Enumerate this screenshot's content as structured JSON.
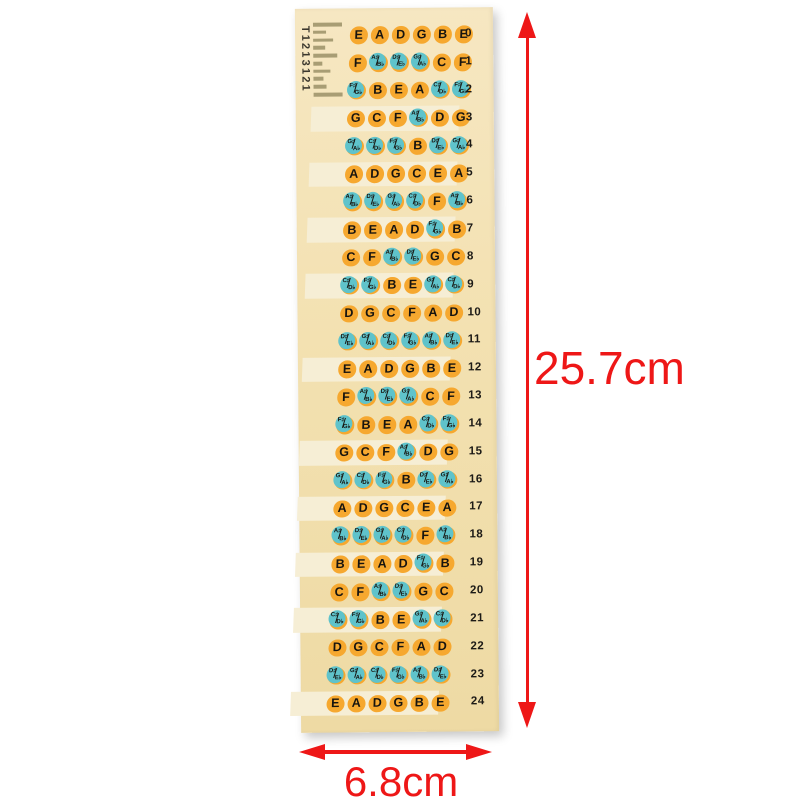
{
  "dimensions": {
    "height_label": "25.7cm",
    "width_label": "6.8cm"
  },
  "regmarks": {
    "text": "T1213121",
    "bar_widths": [
      29,
      13,
      20,
      12,
      24,
      9,
      17,
      10,
      13,
      29
    ]
  },
  "frets": [
    {
      "fret": "0",
      "marker": false,
      "notes": [
        "E",
        "A",
        "D",
        "G",
        "B",
        "E"
      ]
    },
    {
      "fret": "1",
      "marker": false,
      "notes": [
        "F",
        "A♯/B♭",
        "D♯/E♭",
        "G♯/A♭",
        "C",
        "F"
      ]
    },
    {
      "fret": "2",
      "marker": false,
      "notes": [
        "F♯/G♭",
        "B",
        "E",
        "A",
        "C♯/D♭",
        "F♯/G♭"
      ]
    },
    {
      "fret": "3",
      "marker": true,
      "notes": [
        "G",
        "C",
        "F",
        "A♯/B♭",
        "D",
        "G"
      ]
    },
    {
      "fret": "4",
      "marker": false,
      "notes": [
        "G♯/A♭",
        "C♯/D♭",
        "F♯/G♭",
        "B",
        "D♯/E♭",
        "G♯/A♭"
      ]
    },
    {
      "fret": "5",
      "marker": true,
      "notes": [
        "A",
        "D",
        "G",
        "C",
        "E",
        "A"
      ]
    },
    {
      "fret": "6",
      "marker": false,
      "notes": [
        "A♯/B♭",
        "D♯/E♭",
        "G♯/A♭",
        "C♯/D♭",
        "F",
        "A♯/B♭"
      ]
    },
    {
      "fret": "7",
      "marker": true,
      "notes": [
        "B",
        "E",
        "A",
        "D",
        "F♯/G♭",
        "B"
      ]
    },
    {
      "fret": "8",
      "marker": false,
      "notes": [
        "C",
        "F",
        "A♯/B♭",
        "D♯/E♭",
        "G",
        "C"
      ]
    },
    {
      "fret": "9",
      "marker": true,
      "notes": [
        "C♯/D♭",
        "F♯/G♭",
        "B",
        "E",
        "G♯/A♭",
        "C♯/D♭"
      ]
    },
    {
      "fret": "10",
      "marker": false,
      "notes": [
        "D",
        "G",
        "C",
        "F",
        "A",
        "D"
      ]
    },
    {
      "fret": "11",
      "marker": false,
      "notes": [
        "D♯/E♭",
        "G♯/A♭",
        "C♯/D♭",
        "F♯/G♭",
        "A♯/B♭",
        "D♯/E♭"
      ]
    },
    {
      "fret": "12",
      "marker": true,
      "notes": [
        "E",
        "A",
        "D",
        "G",
        "B",
        "E"
      ]
    },
    {
      "fret": "13",
      "marker": false,
      "notes": [
        "F",
        "A♯/B♭",
        "D♯/E♭",
        "G♯/A♭",
        "C",
        "F"
      ]
    },
    {
      "fret": "14",
      "marker": false,
      "notes": [
        "F♯/G♭",
        "B",
        "E",
        "A",
        "C♯/D♭",
        "F♯/G♭"
      ]
    },
    {
      "fret": "15",
      "marker": true,
      "notes": [
        "G",
        "C",
        "F",
        "A♯/B♭",
        "D",
        "G"
      ]
    },
    {
      "fret": "16",
      "marker": false,
      "notes": [
        "G♯/A♭",
        "C♯/D♭",
        "F♯/G♭",
        "B",
        "D♯/E♭",
        "G♯/A♭"
      ]
    },
    {
      "fret": "17",
      "marker": true,
      "notes": [
        "A",
        "D",
        "G",
        "C",
        "E",
        "A"
      ]
    },
    {
      "fret": "18",
      "marker": false,
      "notes": [
        "A♯/B♭",
        "D♯/E♭",
        "G♯/A♭",
        "C♯/D♭",
        "F",
        "A♯/B♭"
      ]
    },
    {
      "fret": "19",
      "marker": true,
      "notes": [
        "B",
        "E",
        "A",
        "D",
        "F♯/G♭",
        "B"
      ]
    },
    {
      "fret": "20",
      "marker": false,
      "notes": [
        "C",
        "F",
        "A♯/B♭",
        "D♯/E♭",
        "G",
        "C"
      ]
    },
    {
      "fret": "21",
      "marker": true,
      "notes": [
        "C♯/D♭",
        "F♯/G♭",
        "B",
        "E",
        "G♯/A♭",
        "C♯/D♭"
      ]
    },
    {
      "fret": "22",
      "marker": false,
      "notes": [
        "D",
        "G",
        "C",
        "F",
        "A",
        "D"
      ]
    },
    {
      "fret": "23",
      "marker": false,
      "notes": [
        "D♯/E♭",
        "G♯/A♭",
        "C♯/D♭",
        "F♯/G♭",
        "A♯/B♭",
        "D♯/E♭"
      ]
    },
    {
      "fret": "24",
      "marker": true,
      "notes": [
        "E",
        "A",
        "D",
        "G",
        "B",
        "E"
      ]
    }
  ],
  "colors": {
    "background": "#ffffff",
    "sheet": "#f3e1b1",
    "marker_band": "#f6eed5",
    "dot_natural": "#f6a82f",
    "dot_accidental": "#5fc3cb",
    "note_text": "#17140f",
    "fret_number_text": "#1c1a16",
    "dimension_red": "#ee1717",
    "regmark_bar": "#a89d74",
    "regmark_text": "#3b372d"
  }
}
